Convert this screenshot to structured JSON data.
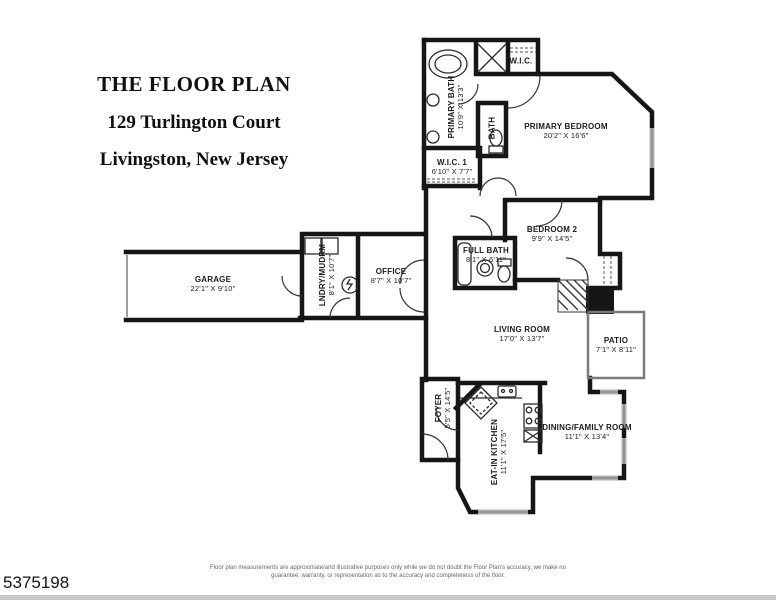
{
  "page": {
    "listing_id": "5375198",
    "disclaimer_line1": "Floor plan measurements are approximate/and illustrative purposes only while we do not doubt the Floor Plan's accuracy, we make no",
    "disclaimer_line2": "guarantee, warranty, or representation as to the accuracy and completeness of the floor.",
    "background_color": "#ffffff",
    "wall_color": "#1a1a1a",
    "window_color": "#b0b0b0",
    "footer_bar_color": "#c9c9c9"
  },
  "title": {
    "line1": "THE FLOOR PLAN",
    "line2": "129 Turlington Court",
    "line3": "Livingston, New Jersey"
  },
  "rooms": {
    "primary_bath": {
      "name": "PRIMARY BATH",
      "dims": "10'9\" X 13'3\""
    },
    "wic": {
      "name": "W.I.C."
    },
    "bath": {
      "name": "BATH"
    },
    "primary_bedroom": {
      "name": "PRIMARY BEDROOM",
      "dims": "20'2\" X 16'6\""
    },
    "wic1": {
      "name": "W.I.C. 1",
      "dims": "6'10\" X 7'7\""
    },
    "bedroom2": {
      "name": "BEDROOM 2",
      "dims": "9'9\" X 14'5\""
    },
    "full_bath": {
      "name": "FULL BATH",
      "dims": "8'1\" X 6'11\""
    },
    "garage": {
      "name": "GARAGE",
      "dims": "22'1\" X 9'10\""
    },
    "laundry_mudroom": {
      "name": "LNDRY/MUDRM",
      "dims": "8'1\" X 10'7\""
    },
    "office": {
      "name": "OFFICE",
      "dims": "8'7\" X 10'7\""
    },
    "living_room": {
      "name": "LIVING ROOM",
      "dims": "17'0\" X 13'7\""
    },
    "patio": {
      "name": "PATIO",
      "dims": "7'1\" X 8'11\""
    },
    "foyer": {
      "name": "FOYER",
      "dims": "5'5\" X 14'5\""
    },
    "eat_in_kitchen": {
      "name": "EAT-IN KITCHEN",
      "dims": "11'1\" X 17'5\""
    },
    "dining_family_room": {
      "name": "DINING/FAMILY ROOM",
      "dims": "11'1\" X 13'4\""
    }
  }
}
